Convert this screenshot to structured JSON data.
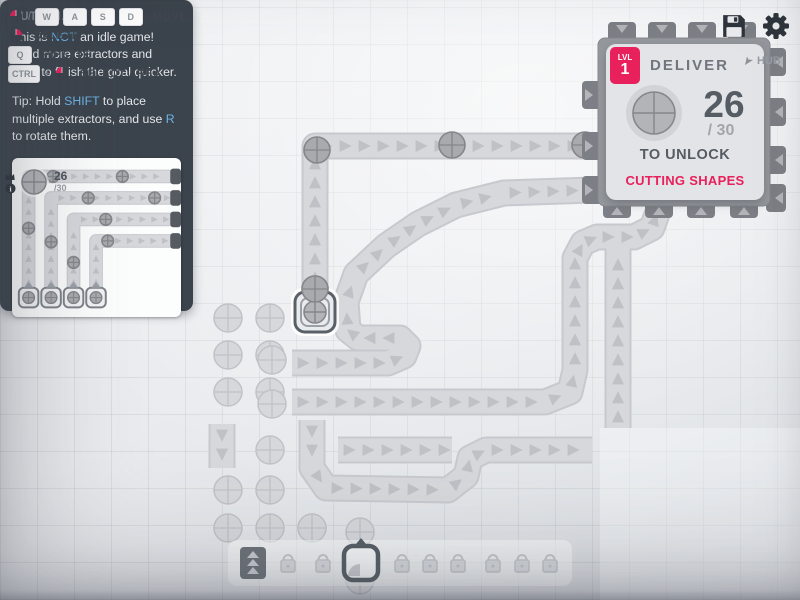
{
  "colors": {
    "accent": "#e8205b",
    "link": "#6cb2e8",
    "belt_fill": "#d6d8dc",
    "belt_edge": "#c7c9ce",
    "chevron": "#b9bbc0",
    "item_fill": "#a8aaae",
    "item_stroke": "#84868b",
    "resource_fill": "#d6d8dc",
    "resource_stroke": "#c0c2c7",
    "hub_body": "#95989d",
    "hub_tab": "#7c7f85",
    "dark_icon": "#2e343b"
  },
  "hints": {
    "move": {
      "slash": "/",
      "keys": [
        "W",
        "A",
        "S",
        "D"
      ],
      "label": "MOVE"
    },
    "delete": {
      "label": "DELETE"
    },
    "pipette": {
      "key": "Q",
      "label": "PIPETTE"
    },
    "select": {
      "key": "CTRL",
      "plus": "+",
      "label": "SELECT AREA"
    }
  },
  "topbar": {
    "icons": [
      "save-icon",
      "settings-gear-icon"
    ]
  },
  "pinned_goal": {
    "amount": "26",
    "total": "/30",
    "shape": "circle"
  },
  "hub": {
    "level_label": "LVL",
    "level": "1",
    "title": "DELIVER",
    "amount": "26",
    "total": "/ 30",
    "unlock_label": "TO UNLOCK",
    "reward": "CUTTING SHAPES",
    "map_label": "HUB",
    "shape": "circle"
  },
  "tutorial": {
    "title": "TUTORIAL",
    "paragraphs": [
      [
        {
          "t": "This is "
        },
        {
          "t": "NOT",
          "hl": true
        },
        {
          "t": " an idle game! Build more extractors and belts to finish the goal quicker."
        }
      ],
      [
        {
          "t": "Tip: Hold "
        },
        {
          "t": "SHIFT",
          "hl": true
        },
        {
          "t": " to place multiple extractors, and use "
        },
        {
          "t": "R",
          "hl": true
        },
        {
          "t": " to rotate them."
        }
      ]
    ],
    "illustration": {
      "belts": [
        [
          [
            17,
            148
          ],
          [
            17,
            17
          ],
          [
            164,
            17
          ]
        ],
        [
          [
            40,
            148
          ],
          [
            40,
            39
          ],
          [
            164,
            39
          ]
        ],
        [
          [
            63,
            148
          ],
          [
            63,
            61
          ],
          [
            164,
            61
          ]
        ],
        [
          [
            86,
            148
          ],
          [
            86,
            83
          ],
          [
            164,
            83
          ]
        ]
      ],
      "items": [
        [
          42,
          17
        ],
        [
          113,
          17
        ],
        [
          78,
          39
        ],
        [
          146,
          39
        ],
        [
          96,
          61
        ],
        [
          17,
          70
        ],
        [
          40,
          84
        ],
        [
          63,
          105
        ],
        [
          98,
          83
        ]
      ],
      "extractors": [
        [
          17,
          141
        ],
        [
          40,
          141
        ],
        [
          63,
          141
        ],
        [
          86,
          141
        ]
      ],
      "stubs": [
        [
          164,
          17
        ],
        [
          164,
          39
        ],
        [
          164,
          61
        ],
        [
          164,
          83
        ]
      ]
    }
  },
  "toolbar": {
    "slots": [
      {
        "type": "belt",
        "x": 253,
        "selected": false
      },
      {
        "type": "locked",
        "x": 288,
        "selected": false
      },
      {
        "type": "locked",
        "x": 323,
        "selected": false
      },
      {
        "type": "extractor",
        "x": 361,
        "selected": true
      },
      {
        "type": "locked",
        "x": 402,
        "selected": false
      },
      {
        "type": "locked",
        "x": 430,
        "selected": false
      },
      {
        "type": "locked",
        "x": 458,
        "selected": false
      },
      {
        "type": "locked",
        "x": 493,
        "selected": false
      },
      {
        "type": "locked",
        "x": 522,
        "selected": false
      },
      {
        "type": "locked",
        "x": 550,
        "selected": false
      }
    ]
  },
  "map": {
    "belts": [
      {
        "points": [
          [
            315,
            308
          ],
          [
            315,
            146
          ],
          [
            592,
            146
          ]
        ]
      },
      {
        "points": [
          [
            292,
            363
          ],
          [
            388,
            363
          ],
          [
            404,
            356
          ],
          [
            408,
            346
          ],
          [
            400,
            338
          ],
          [
            358,
            338
          ],
          [
            348,
            330
          ],
          [
            346,
            302
          ],
          [
            356,
            274
          ],
          [
            386,
            246
          ],
          [
            418,
            224
          ],
          [
            456,
            205
          ],
          [
            504,
            193
          ],
          [
            592,
            190
          ]
        ]
      },
      {
        "points": [
          [
            292,
            402
          ],
          [
            545,
            402
          ],
          [
            570,
            392
          ],
          [
            575,
            370
          ],
          [
            575,
            258
          ],
          [
            583,
            243
          ],
          [
            597,
            237
          ],
          [
            634,
            237
          ],
          [
            652,
            228
          ],
          [
            657,
            214
          ]
        ]
      },
      {
        "points": [
          [
            618,
            428
          ],
          [
            618,
            247
          ]
        ]
      },
      {
        "points": [
          [
            312,
            420
          ],
          [
            312,
            468
          ],
          [
            326,
            488
          ],
          [
            448,
            490
          ],
          [
            466,
            476
          ],
          [
            470,
            458
          ],
          [
            486,
            450
          ],
          [
            592,
            450
          ]
        ]
      },
      {
        "points": [
          [
            338,
            450
          ],
          [
            452,
            450
          ]
        ]
      },
      {
        "points": [
          [
            222,
            424
          ],
          [
            222,
            468
          ]
        ]
      }
    ],
    "items": [
      [
        452,
        145
      ],
      [
        585,
        145
      ],
      [
        317,
        150
      ],
      [
        315,
        289
      ]
    ],
    "resources": [
      [
        228,
        318
      ],
      [
        270,
        318
      ],
      [
        228,
        355
      ],
      [
        270,
        355
      ],
      [
        228,
        392
      ],
      [
        270,
        392
      ],
      [
        272,
        360
      ],
      [
        272,
        404
      ],
      [
        270,
        450
      ],
      [
        228,
        490
      ],
      [
        270,
        490
      ],
      [
        228,
        528
      ],
      [
        270,
        528
      ],
      [
        312,
        528
      ],
      [
        360,
        532
      ],
      [
        360,
        580
      ]
    ],
    "extractor": {
      "x": 315,
      "y": 312
    },
    "hub_building": {
      "x": 598,
      "y": 38,
      "w": 172,
      "h": 168,
      "tabs": [
        {
          "x": 617,
          "y": 208,
          "dir": "up"
        },
        {
          "x": 659,
          "y": 208,
          "dir": "up"
        },
        {
          "x": 701,
          "y": 208,
          "dir": "up"
        },
        {
          "x": 744,
          "y": 208,
          "dir": "up"
        },
        {
          "x": 592,
          "y": 146,
          "dir": "right"
        },
        {
          "x": 592,
          "y": 190,
          "dir": "right"
        },
        {
          "x": 592,
          "y": 95,
          "dir": "right"
        },
        {
          "x": 776,
          "y": 62,
          "dir": "left"
        },
        {
          "x": 776,
          "y": 112,
          "dir": "left"
        },
        {
          "x": 776,
          "y": 160,
          "dir": "left"
        },
        {
          "x": 776,
          "y": 198,
          "dir": "left"
        },
        {
          "x": 622,
          "y": 32,
          "dir": "down"
        },
        {
          "x": 662,
          "y": 32,
          "dir": "down"
        },
        {
          "x": 702,
          "y": 32,
          "dir": "down"
        },
        {
          "x": 742,
          "y": 32,
          "dir": "down"
        }
      ]
    }
  }
}
